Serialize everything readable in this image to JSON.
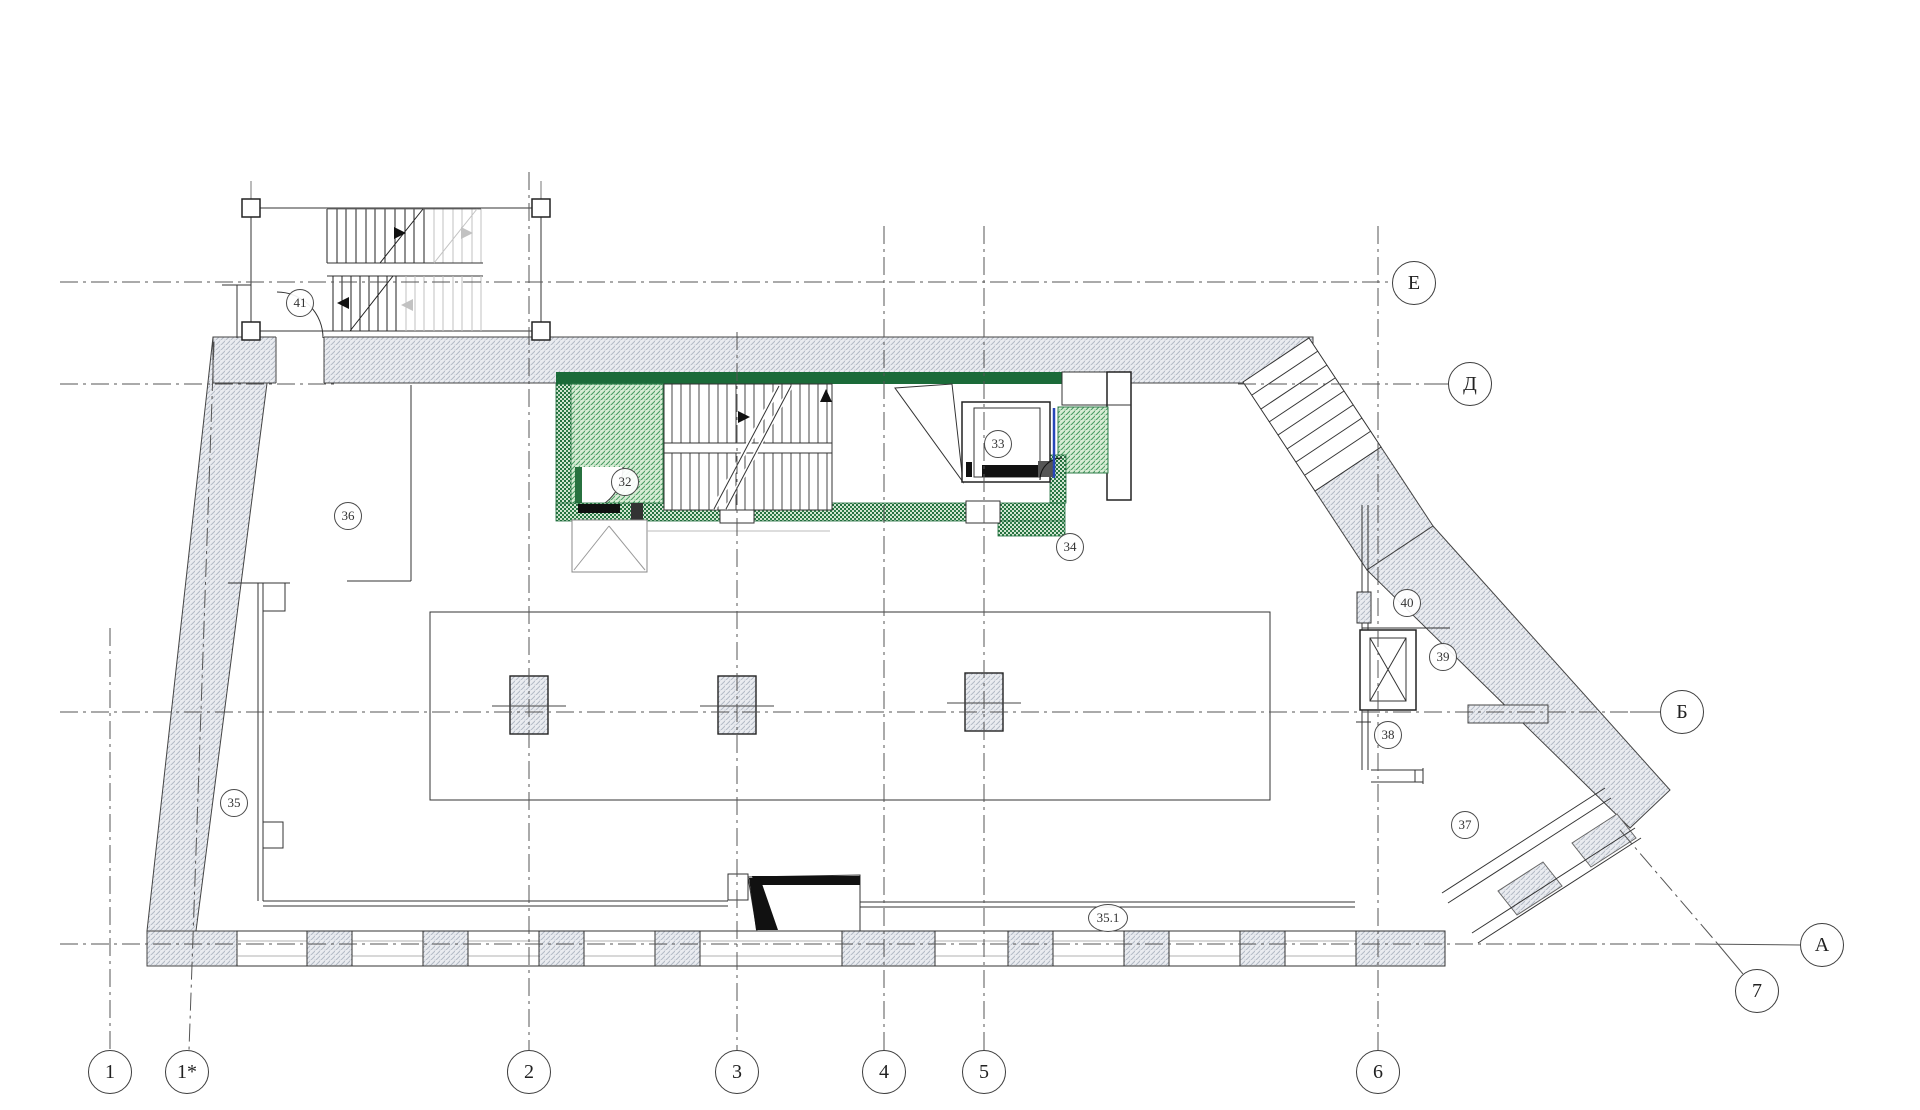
{
  "plan": {
    "axis_labels_vertical": [
      "1",
      "1*",
      "2",
      "3",
      "4",
      "5",
      "6",
      "7"
    ],
    "axis_labels_horizontal": [
      "Е",
      "Д",
      "Б",
      "А"
    ],
    "room_numbers": [
      "32",
      "33",
      "34",
      "35",
      "35.1",
      "36",
      "37",
      "38",
      "39",
      "40",
      "41"
    ],
    "colors": {
      "stair_zone_green": "#1b6b39",
      "hatch_green_line": "#3f9960",
      "elevator_door_blue": "#2746b8",
      "wall_hatch_gray": "#b3bac6"
    }
  }
}
